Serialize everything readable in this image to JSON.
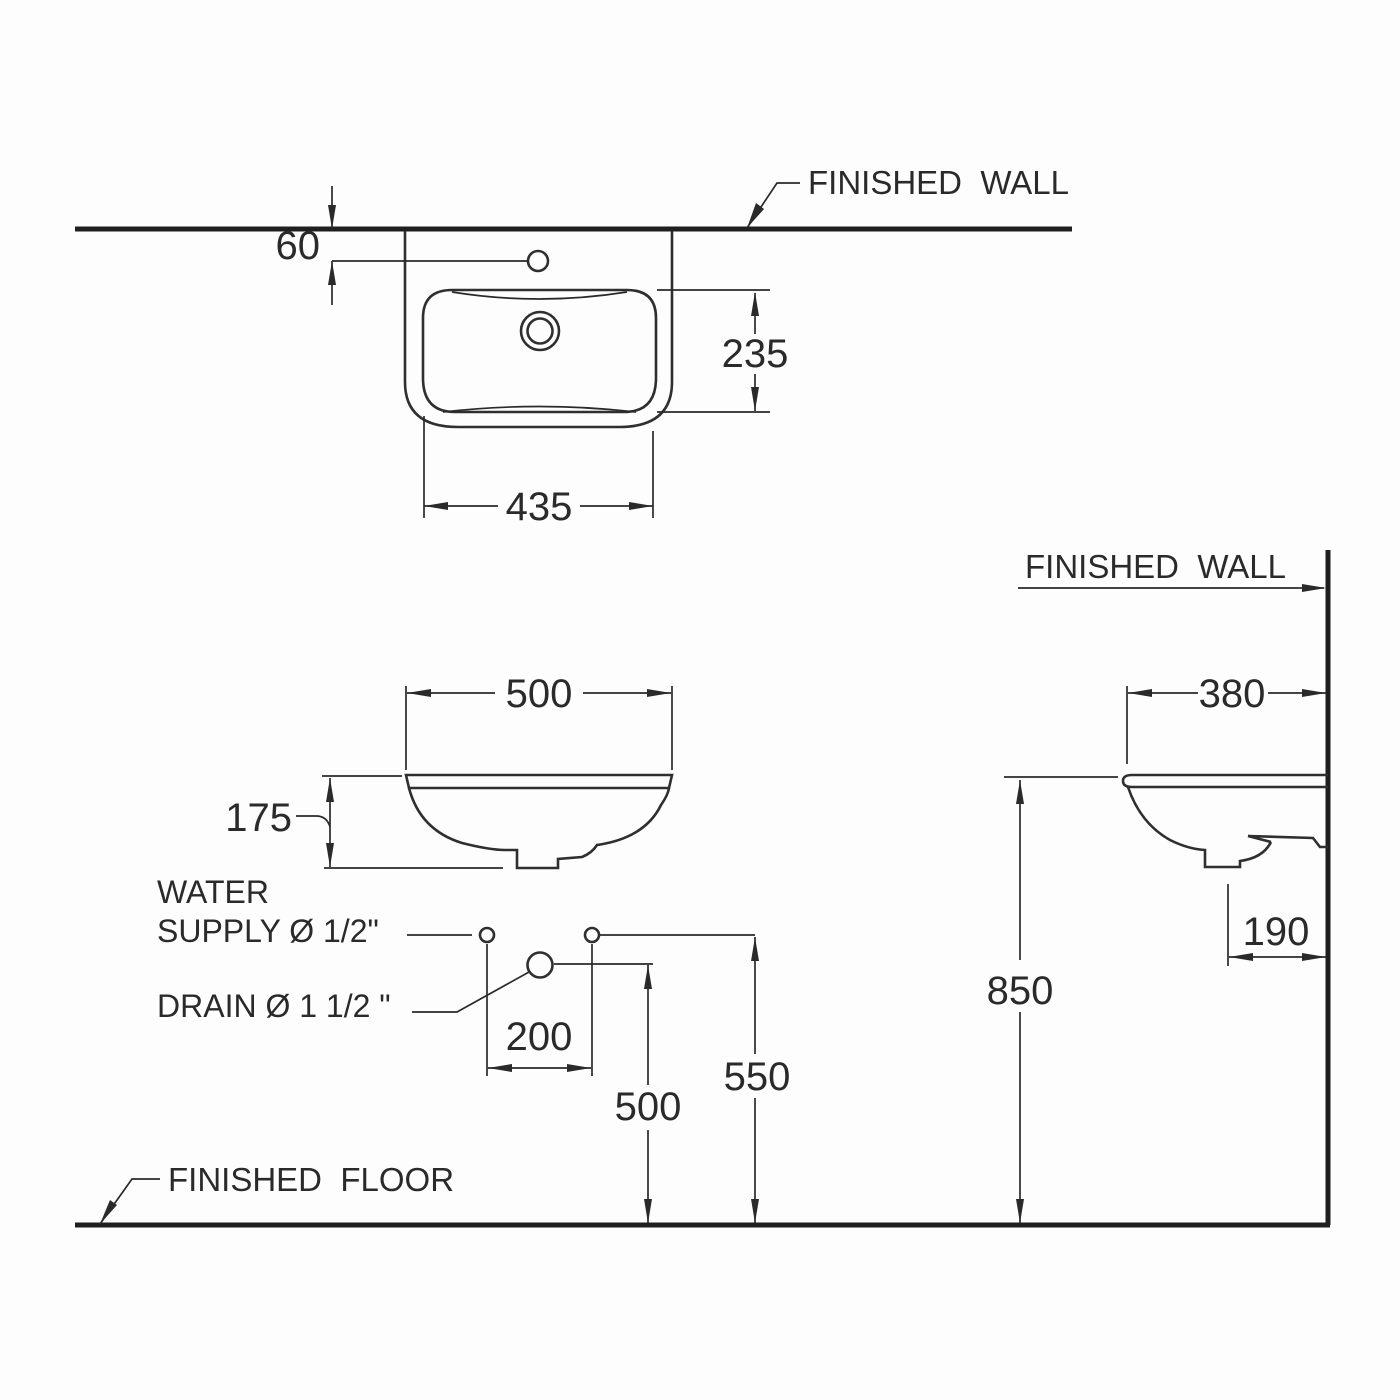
{
  "drawing": {
    "type": "sanitary-ware installation dimension drawing",
    "labels": {
      "finished_wall_top": "FINISHED  WALL",
      "finished_wall_side": "FINISHED  WALL",
      "finished_floor": "FINISHED  FLOOR",
      "water_supply_line1": "WATER",
      "water_supply_line2": "SUPPLY Ø 1/2\"",
      "drain_label": "DRAIN Ø 1 1/2 \""
    },
    "dimensions": {
      "faucet_hole_to_wall": "60",
      "bowl_front_to_back": "235",
      "bowl_width": "435",
      "rim_width": "500",
      "bowl_depth": "175",
      "supply_spacing": "200",
      "drain_height": "500",
      "supply_height": "550",
      "rim_projection": "380",
      "outlet_to_wall": "190",
      "rim_height": "850"
    },
    "colors": {
      "ink": "#2a2a2a",
      "background": "#ffffff"
    }
  }
}
